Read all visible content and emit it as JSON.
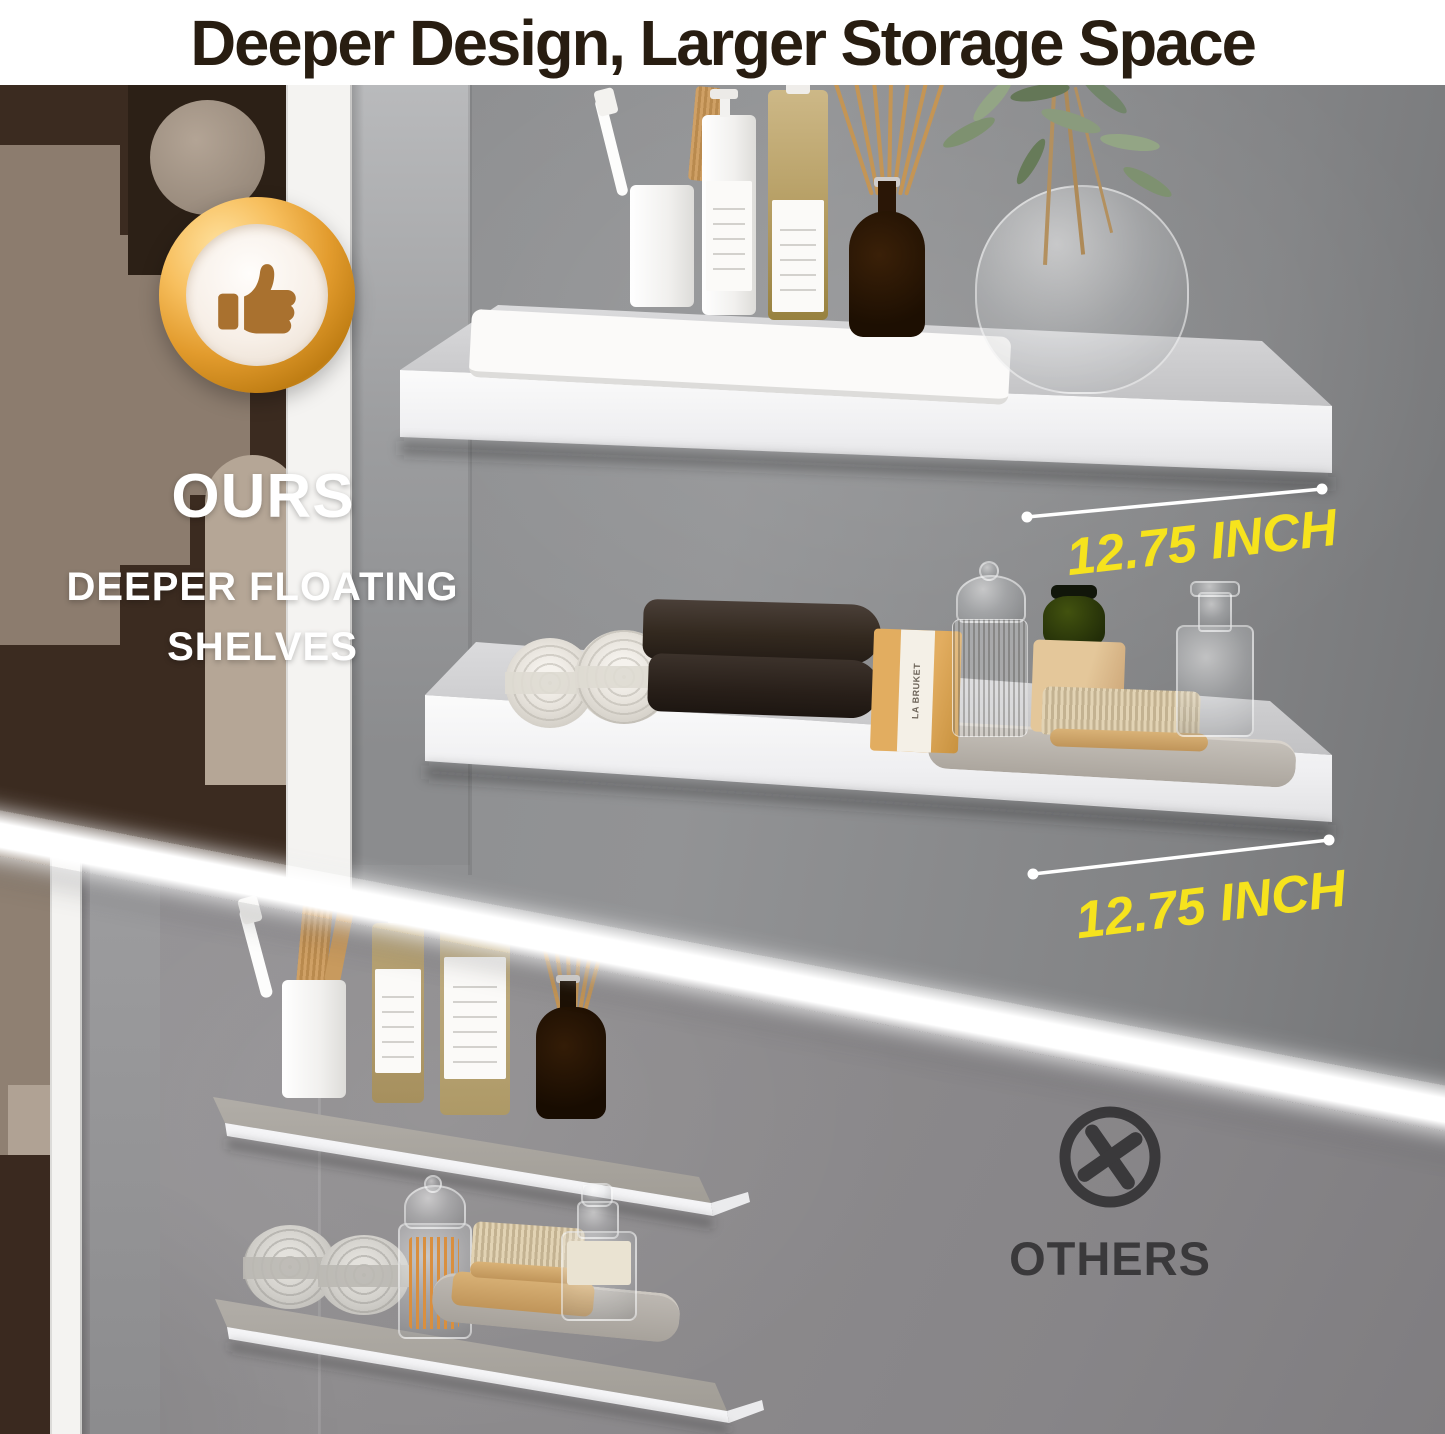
{
  "title": "Deeper Design, Larger Storage Space",
  "ours_section": {
    "badge_icon": "thumbs-up-badge",
    "heading": "OURS",
    "subheading": "DEEPER FLOATING SHELVES",
    "measurement_top_shelf": "12.75 INCH",
    "measurement_bottom_shelf": "12.75 INCH"
  },
  "others_section": {
    "icon": "x-circle",
    "heading": "OTHERS"
  },
  "product_labels": {
    "soap_box": "LA BRUKET"
  },
  "colors": {
    "accent_yellow": "#F6E31D",
    "title_text": "#281D11",
    "light_text": "#FFFFFF",
    "dark_text": "#3A393B",
    "badge_gold": "#E29B2D",
    "badge_thumb": "#A9712F",
    "wall_gray": "#8E8C8E",
    "shelf_white": "#F7F7F9"
  }
}
